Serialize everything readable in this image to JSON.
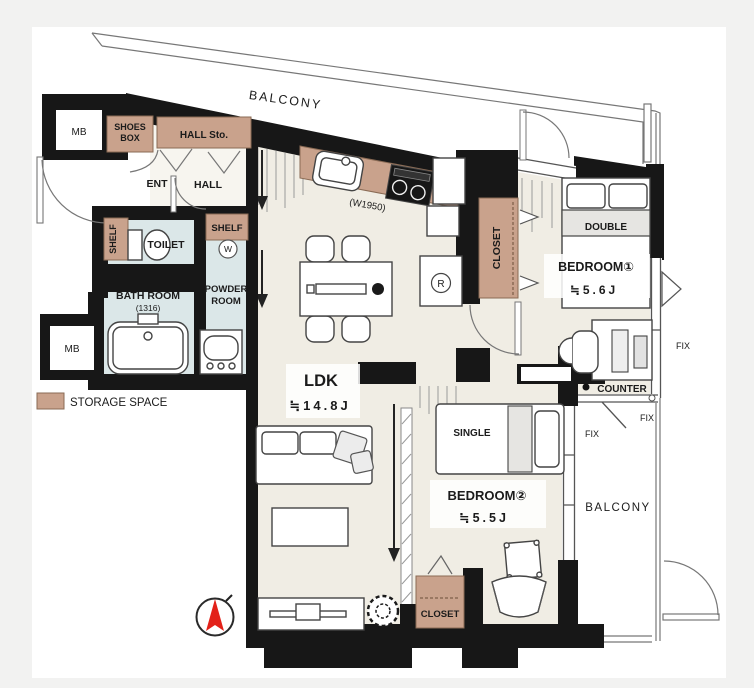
{
  "title": "apartment-floor-plan",
  "colors": {
    "canvas": "#f2f2f1",
    "paper": "#ffffff",
    "wall": "#171717",
    "floor_cream": "#f0ede4",
    "wet_blue": "#dbe7e8",
    "storage_brown": "#c9a28c",
    "storage_border": "#8a6b55",
    "bed_band_gray": "#e6e5e2",
    "north_red": "#e32119"
  },
  "labels": {
    "balcony": "BALCONY",
    "mb": "MB",
    "shoes_box_line1": "SHOES",
    "shoes_box_line2": "BOX",
    "hall_storage": "HALL Sto.",
    "entrance": "ENT",
    "hall": "HALL",
    "toilet": "TOILET",
    "shelf": "SHELF",
    "washer": "W",
    "bath_room": "BATH ROOM",
    "bath_size": "(1316)",
    "powder_line1": "POWDER",
    "powder_line2": "ROOM",
    "storage_legend": "STORAGE SPACE",
    "ldk": "LDK",
    "ldk_size": "≒14.8J",
    "kitchen_width": "(W1950)",
    "fridge": "R",
    "closet": "CLOSET",
    "bedroom1": "BEDROOM①",
    "bedroom1_size": "≒5.6J",
    "double_bed": "DOUBLE",
    "counter": "COUNTER",
    "fix": "FIX",
    "single_bed": "SINGLE",
    "bedroom2": "BEDROOM②",
    "bedroom2_size": "≒5.5J"
  }
}
